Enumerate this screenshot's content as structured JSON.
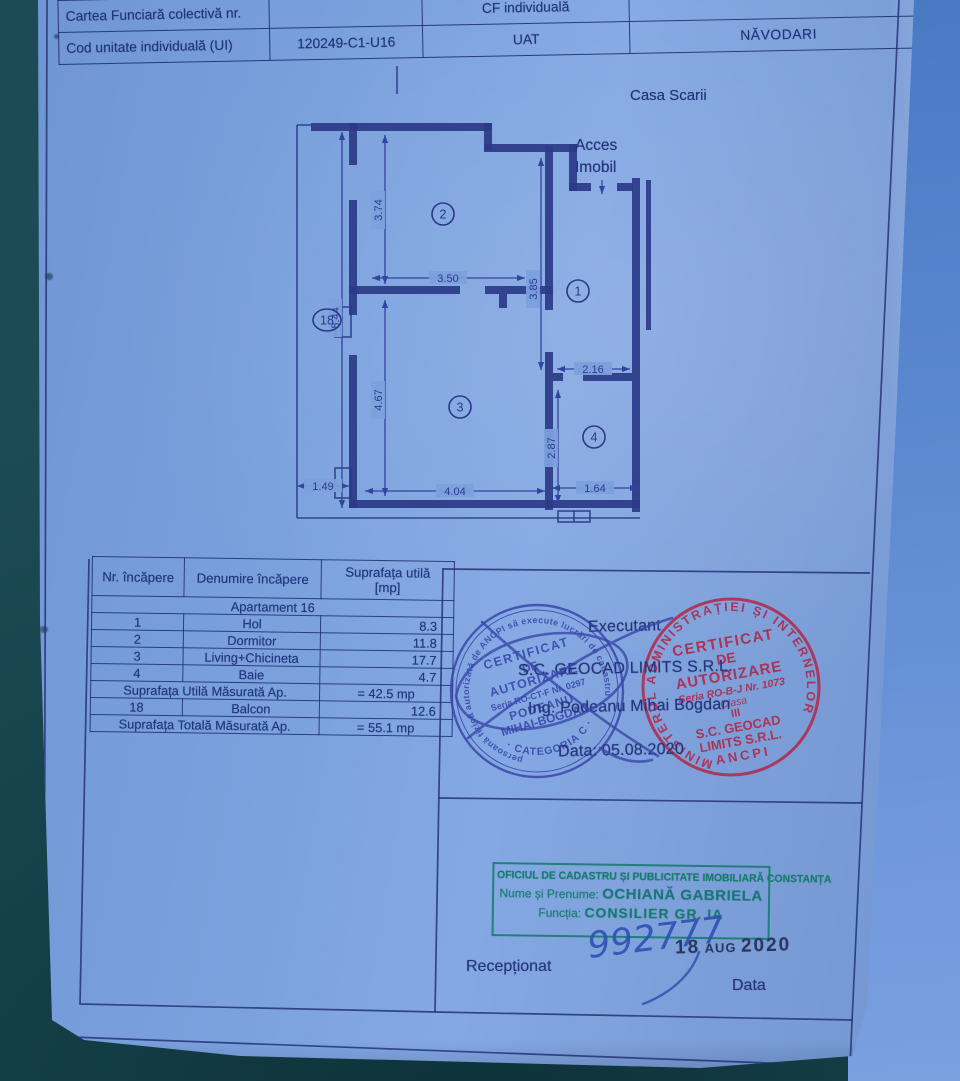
{
  "document": {
    "header_table": {
      "row1": {
        "c1": "Cartea Funciară colectivă nr.",
        "c2": "",
        "c3": "CF individuală",
        "c4": ""
      },
      "row2": {
        "c1": "Cod unitate individuală (UI)",
        "c2": "120249-C1-U16",
        "c3": "UAT",
        "c4": "NĂVODARI"
      }
    },
    "plan": {
      "staircase_label": "Casa Scarii",
      "access_line1": "Acces",
      "access_line2": "Imobil",
      "room_numbers": {
        "r1": "1",
        "r2": "2",
        "r3": "3",
        "r4": "4",
        "r18": "18"
      },
      "dims": {
        "d844": "8.44",
        "d374": "3.74",
        "d467": "4.67",
        "d350": "3.50",
        "d385": "3.85",
        "d216": "2.16",
        "d287": "2.87",
        "d149": "1.49",
        "d404": "4.04",
        "d164": "1.64"
      }
    },
    "room_table": {
      "col1": "Nr. încăpere",
      "col2": "Denumire încăpere",
      "col3a": "Suprafața utilă",
      "col3b": "[mp]",
      "group": "Apartament 16",
      "rows": [
        {
          "nr": "1",
          "name": "Hol",
          "area": "8.3"
        },
        {
          "nr": "2",
          "name": "Dormitor",
          "area": "11.8"
        },
        {
          "nr": "3",
          "name": "Living+Chicineta",
          "area": "17.7"
        },
        {
          "nr": "4",
          "name": "Baie",
          "area": "4.7"
        }
      ],
      "subtotal_label": "Suprafața Utilă Măsurată Ap.",
      "subtotal_value": "= 42.5 mp",
      "balcony": {
        "nr": "18",
        "name": "Balcon",
        "area": "12.6"
      },
      "total_label": "Suprafața Totală Măsurată Ap.",
      "total_value": "= 55.1 mp"
    },
    "executant": {
      "label": "Executant",
      "company": "S.C. GEOCAD LIMITS S.R.L.",
      "engineer": "Ing. Podeanu Mihai Bogdan",
      "date": "Data: 05.08.2020"
    },
    "stamp_blue": {
      "ring_text": "persoană fizică autorizată de ANCPI să execute lucrări de cadastru",
      "line1": "CERTIFICAT",
      "line2": "DE",
      "line3": "AUTORIZARE",
      "serial": "Seria RO-CT-F Nr. 0297",
      "name1": "PODEANU",
      "name2": "MIHAI-BOGDAN",
      "category": "· CATEGORIA C ·"
    },
    "stamp_red": {
      "ring_text": "MINISTERUL ADMINISTRAȚIEI ȘI INTERNELOR",
      "line1": "CERTIFICAT",
      "line2": "DE",
      "line3": "AUTORIZARE",
      "serial": "Seria RO-B-J Nr. 1073",
      "class_label": "Clasa",
      "class_value": "III",
      "company1": "S.C. GEOCAD",
      "company2": "LIMITS S.R.L.",
      "footer": "ANCPI"
    },
    "stamp_green": {
      "line1": "OFICIUL DE CADASTRU ȘI PUBLICITATE IMOBILIARĂ CONSTANȚA",
      "name_label": "Nume și Prenume:",
      "name_value": "OCHIANĂ GABRIELA",
      "role_label": "Funcția:",
      "role_value": "CONSILIER GR. IA"
    },
    "reception": {
      "received": "Recepționat",
      "number": "992777",
      "date_day": "18",
      "date_month": "AUG",
      "date_year": "2020",
      "date_label": "Data"
    }
  },
  "colors": {
    "paper_blue": "#7ba0dc",
    "background_teal": "#17434c",
    "ink_navy": "#23357d",
    "stamp_blue_ink": "#3a47ab",
    "stamp_red_ink": "#b02848",
    "stamp_green_ink": "#157a6c",
    "pen_blue": "#2d52b0"
  }
}
